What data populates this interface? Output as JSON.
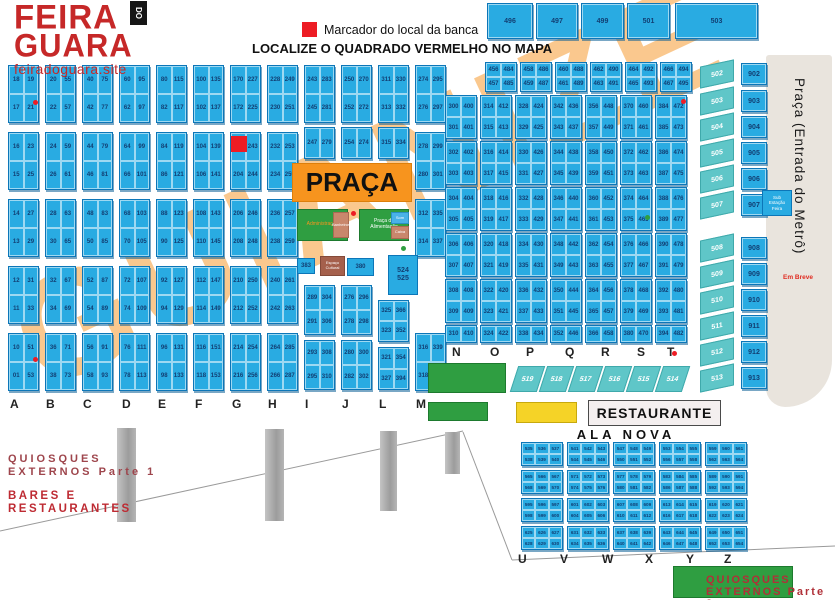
{
  "header": {
    "logo_line1": "FEIRA",
    "logo_do": "DO",
    "logo_line2": "GUARA",
    "logo_site": "feiradoguara.site",
    "legend_marker": "Marcador do local da banca",
    "headline": "LOCALIZE O QUADRADO VERMELHO NO MAPA"
  },
  "watermark": "GUIANIZE",
  "colors": {
    "cell_blue": "#29ABE2",
    "cell_border": "#0C76B8",
    "teal": "#5FC6C8",
    "orange": "#F7941E",
    "green": "#2F9E41",
    "yellow": "#F5D327",
    "red": "#ED1C24",
    "dark_red": "#BE2B33",
    "number_navy": "#123F73",
    "gray_area": "#E9E4DD",
    "brown": "#A5604C",
    "tan": "#C9876C"
  },
  "top_row": {
    "y": 3,
    "h": 36,
    "boxes": [
      [
        487,
        46,
        "496"
      ],
      [
        536,
        42,
        "497"
      ],
      [
        581,
        43,
        "499"
      ],
      [
        627,
        43,
        "501"
      ],
      [
        675,
        83,
        "503"
      ]
    ]
  },
  "mini_row": {
    "y": 62,
    "h": 30,
    "w": 32,
    "boxes": [
      [
        485,
        "456,484,457,485"
      ],
      [
        520,
        "458,486,459,487"
      ],
      [
        555,
        "460,488,461,489"
      ],
      [
        590,
        "462,490,463,491"
      ],
      [
        625,
        "464,492,465,493"
      ],
      [
        660,
        "466,494,467,495"
      ]
    ]
  },
  "left_block": {
    "w": 31,
    "letters_y": 397,
    "letters": [
      [
        "A",
        10
      ],
      [
        "B",
        46
      ],
      [
        "C",
        83
      ],
      [
        "D",
        122
      ],
      [
        "E",
        158
      ],
      [
        "F",
        195
      ],
      [
        "G",
        232
      ],
      [
        "H",
        268
      ],
      [
        "I",
        305
      ],
      [
        "J",
        342
      ],
      [
        "L",
        379
      ],
      [
        "M",
        416
      ]
    ],
    "columns": [
      {
        "x": 8,
        "boxes": [
          {
            "y": 65,
            "h": 58,
            "n": "18,19,17,21"
          },
          {
            "y": 132,
            "h": 58,
            "n": "16,23,15,25"
          },
          {
            "y": 199,
            "h": 58,
            "n": "14,27,13,29"
          },
          {
            "y": 266,
            "h": 58,
            "n": "12,31,11,33"
          },
          {
            "y": 333,
            "h": 58,
            "n": "10,51,01,53"
          }
        ]
      },
      {
        "x": 45,
        "boxes": [
          {
            "y": 65,
            "h": 58,
            "n": "20,55,22,57"
          },
          {
            "y": 132,
            "h": 58,
            "n": "24,59,26,61"
          },
          {
            "y": 199,
            "h": 58,
            "n": "28,63,30,65"
          },
          {
            "y": 266,
            "h": 58,
            "n": "32,67,34,69"
          },
          {
            "y": 333,
            "h": 58,
            "n": "36,71,38,73"
          }
        ]
      },
      {
        "x": 82,
        "boxes": [
          {
            "y": 65,
            "h": 58,
            "n": "40,75,42,77"
          },
          {
            "y": 132,
            "h": 58,
            "n": "44,79,46,81"
          },
          {
            "y": 199,
            "h": 58,
            "n": "48,83,50,85"
          },
          {
            "y": 266,
            "h": 58,
            "n": "52,87,54,89"
          },
          {
            "y": 333,
            "h": 58,
            "n": "56,91,58,93"
          }
        ]
      },
      {
        "x": 119,
        "boxes": [
          {
            "y": 65,
            "h": 58,
            "n": "60,95,62,97"
          },
          {
            "y": 132,
            "h": 58,
            "n": "64,99,66,101"
          },
          {
            "y": 199,
            "h": 58,
            "n": "68,103,70,105"
          },
          {
            "y": 266,
            "h": 58,
            "n": "72,107,74,109"
          },
          {
            "y": 333,
            "h": 58,
            "n": "76,111,78,113"
          }
        ]
      },
      {
        "x": 156,
        "boxes": [
          {
            "y": 65,
            "h": 58,
            "n": "80,115,82,117"
          },
          {
            "y": 132,
            "h": 58,
            "n": "84,119,86,121"
          },
          {
            "y": 199,
            "h": 58,
            "n": "88,123,90,125"
          },
          {
            "y": 266,
            "h": 58,
            "n": "92,127,94,129"
          },
          {
            "y": 333,
            "h": 58,
            "n": "96,131,98,133"
          }
        ]
      },
      {
        "x": 193,
        "boxes": [
          {
            "y": 65,
            "h": 58,
            "n": "100,135,102,137"
          },
          {
            "y": 132,
            "h": 58,
            "n": "104,139,106,141"
          },
          {
            "y": 199,
            "h": 58,
            "n": "108,143,110,145"
          },
          {
            "y": 266,
            "h": 58,
            "n": "112,147,114,149"
          },
          {
            "y": 333,
            "h": 58,
            "n": "116,151,118,153"
          }
        ]
      },
      {
        "x": 230,
        "boxes": [
          {
            "y": 65,
            "h": 58,
            "n": "170,227,172,225"
          },
          {
            "y": 132,
            "h": 58,
            "n": ",243,204,244"
          },
          {
            "y": 199,
            "h": 58,
            "n": "206,246,208,248"
          },
          {
            "y": 266,
            "h": 58,
            "n": "210,250,212,252"
          },
          {
            "y": 333,
            "h": 58,
            "n": "214,254,216,256"
          }
        ]
      },
      {
        "x": 267,
        "boxes": [
          {
            "y": 65,
            "h": 58,
            "n": "228,249,230,251"
          },
          {
            "y": 132,
            "h": 58,
            "n": "232,253,234,255"
          },
          {
            "y": 199,
            "h": 58,
            "n": "236,257,238,259"
          },
          {
            "y": 266,
            "h": 58,
            "n": "240,261,242,263"
          },
          {
            "y": 333,
            "h": 58,
            "n": "264,285,266,287"
          }
        ]
      },
      {
        "x": 304,
        "boxes": [
          {
            "y": 65,
            "h": 58,
            "n": "243,283,245,281"
          },
          {
            "y": 127,
            "h": 32,
            "n": "247,279"
          },
          {
            "y": 285,
            "h": 50,
            "n": "289,304,291,306"
          },
          {
            "y": 340,
            "h": 50,
            "n": "293,308,295,310"
          }
        ]
      },
      {
        "x": 341,
        "boxes": [
          {
            "y": 65,
            "h": 58,
            "n": "250,270,252,272"
          },
          {
            "y": 127,
            "h": 32,
            "n": "254,274"
          },
          {
            "y": 285,
            "h": 50,
            "n": "276,296,278,298"
          },
          {
            "y": 340,
            "h": 50,
            "n": "280,300,282,302"
          }
        ]
      },
      {
        "x": 378,
        "boxes": [
          {
            "y": 65,
            "h": 58,
            "n": "311,330,313,332"
          },
          {
            "y": 127,
            "h": 32,
            "n": "315,334"
          },
          {
            "y": 300,
            "h": 42,
            "n": "325,366,323,352"
          },
          {
            "y": 347,
            "h": 43,
            "n": "321,354,327,394"
          }
        ]
      },
      {
        "x": 415,
        "boxes": [
          {
            "y": 65,
            "h": 58,
            "n": "274,295,276,297"
          },
          {
            "y": 132,
            "h": 58,
            "n": "278,299,280,301"
          },
          {
            "y": 199,
            "h": 58,
            "n": "312,335,314,337"
          },
          {
            "y": 333,
            "h": 58,
            "n": "316,339,318,341"
          }
        ]
      }
    ]
  },
  "right_block": {
    "w": 32,
    "letters_y": 345,
    "letters": [
      [
        "N",
        452
      ],
      [
        "O",
        490
      ],
      [
        "P",
        526
      ],
      [
        "Q",
        565
      ],
      [
        "R",
        601
      ],
      [
        "S",
        637
      ],
      [
        "T",
        667
      ]
    ],
    "x": [
      445,
      480,
      515,
      550,
      585,
      620,
      655
    ],
    "rows": [
      {
        "y": 95,
        "h": 44
      },
      {
        "y": 141,
        "h": 44
      },
      {
        "y": 187,
        "h": 44
      },
      {
        "y": 233,
        "h": 44
      },
      {
        "y": 279,
        "h": 44
      },
      {
        "y": 325,
        "h": 18
      }
    ],
    "nums": [
      [
        "300,400,301,401",
        "302,402,303,403",
        "304,404,305,405",
        "306,406,307,407",
        "308,408,309,409",
        "310,410"
      ],
      [
        "314,412,315,413",
        "316,414,317,415",
        "318,416,319,417",
        "320,418,321,419",
        "322,420,323,421",
        "324,422"
      ],
      [
        "328,424,329,425",
        "330,426,331,427",
        "332,428,333,429",
        "334,430,335,431",
        "336,432,337,433",
        "338,434"
      ],
      [
        "342,436,343,437",
        "344,438,345,439",
        "346,440,347,441",
        "348,442,349,443",
        "350,444,351,445",
        "352,446"
      ],
      [
        "356,448,357,449",
        "358,450,359,451",
        "360,452,361,453",
        "362,454,363,455",
        "364,456,365,457",
        "366,458"
      ],
      [
        "370,460,371,461",
        "372,462,373,463",
        "374,464,375,465",
        "376,466,377,467",
        "378,468,379,469",
        "380,470"
      ],
      [
        "384,472,385,473",
        "386,474,387,475",
        "388,476,389,477",
        "390,478,391,479",
        "392,480,393,481",
        "394,482"
      ]
    ]
  },
  "teal_row": {
    "y": 366,
    "w": 27,
    "h": 26,
    "cells": [
      [
        514,
        "519"
      ],
      [
        543,
        "518"
      ],
      [
        572,
        "517"
      ],
      [
        601,
        "516"
      ],
      [
        630,
        "515"
      ],
      [
        659,
        "514"
      ]
    ]
  },
  "teal_col": {
    "x": 700,
    "w": 34,
    "h": 22,
    "cells": [
      [
        63,
        "502"
      ],
      [
        90,
        "503"
      ],
      [
        116,
        "504"
      ],
      [
        142,
        "505"
      ],
      [
        168,
        "506"
      ],
      [
        194,
        "507"
      ],
      [
        237,
        "508"
      ],
      [
        263,
        "509"
      ],
      [
        289,
        "510"
      ],
      [
        315,
        "511"
      ],
      [
        341,
        "512"
      ],
      [
        367,
        "513"
      ]
    ]
  },
  "blue_col": {
    "x": 741,
    "w": 26,
    "h": 22,
    "cells": [
      [
        63,
        "902"
      ],
      [
        90,
        "903"
      ],
      [
        116,
        "904"
      ],
      [
        142,
        "905"
      ],
      [
        168,
        "906"
      ],
      [
        194,
        "907"
      ],
      [
        237,
        "908"
      ],
      [
        263,
        "909"
      ],
      [
        289,
        "910"
      ],
      [
        315,
        "911"
      ],
      [
        341,
        "912"
      ],
      [
        367,
        "913"
      ]
    ]
  },
  "ala_nova_grid": {
    "x": [
      521,
      567,
      613,
      659,
      705
    ],
    "y": [
      442,
      470,
      498,
      526
    ],
    "w": 42,
    "h": 24,
    "letters_y": 552,
    "letters": [
      [
        "U",
        518
      ],
      [
        "V",
        560
      ],
      [
        "W",
        602
      ],
      [
        "X",
        645
      ],
      [
        "Y",
        686
      ],
      [
        "Z",
        724
      ]
    ],
    "nums": [
      "535,536,537,538,539,540",
      "541,542,543,544,545,546",
      "547,548,549,550,551,552",
      "553,554,555,556,557,558",
      "559,560,561,562,563,564",
      "565,566,567,568,569,570",
      "571,572,573,574,575,576",
      "577,578,579,580,581,582",
      "583,584,585,586,587,588",
      "589,590,591,592,593,594",
      "595,596,597,598,599,600",
      "601,602,603,604,605,606",
      "607,608,609,610,611,612",
      "613,614,615,616,617,618",
      "619,620,621,622,623,624",
      "625,626,627,628,629,630",
      "631,632,633,634,635,636",
      "637,638,639,640,641,642",
      "643,644,645,646,647,648",
      "649,650,651,652,653,654"
    ]
  },
  "facilities": [
    {
      "name": "praca-box",
      "x": 292,
      "y": 163,
      "w": 120,
      "h": 39,
      "bg": "#F7941E",
      "border": "#DD7F0B",
      "fg": "#111111",
      "fs": 26,
      "bold": true,
      "text": "PRAÇA"
    },
    {
      "name": "administracao-box",
      "x": 297,
      "y": 209,
      "w": 51,
      "h": 32,
      "bg": "#2F9E41",
      "border": "#1d7a2e",
      "fg": "#F7941E",
      "fs": 5,
      "text": "Administração"
    },
    {
      "name": "banheiros-box",
      "x": 333,
      "y": 212,
      "w": 16,
      "h": 26,
      "bg": "#C9876C",
      "border": "#a96a52",
      "fg": "#ffffff",
      "fs": 4,
      "text": "Banheiros"
    },
    {
      "name": "alimentacao-box",
      "x": 359,
      "y": 209,
      "w": 50,
      "h": 32,
      "bg": "#2F9E41",
      "border": "#1d7a2e",
      "fg": "#ffffff",
      "fs": 5,
      "text": "Praça de\nAlimentação"
    },
    {
      "name": "som-box",
      "x": 391,
      "y": 212,
      "w": 18,
      "h": 12,
      "bg": "#49B2E8",
      "border": "#2a8fc4",
      "fg": "#ffffff",
      "fs": 4,
      "text": "Som"
    },
    {
      "name": "caixa-box",
      "x": 391,
      "y": 226,
      "w": 18,
      "h": 13,
      "bg": "#C9876C",
      "border": "#a96a52",
      "fg": "#ffffff",
      "fs": 4,
      "text": "Caixa"
    },
    {
      "name": "stall-383",
      "x": 297,
      "y": 258,
      "w": 18,
      "h": 16,
      "bg": "#29ABE2",
      "border": "#0C76B8",
      "fg": "#123F73",
      "fs": 6,
      "bold": true,
      "text": "383"
    },
    {
      "name": "espaco-cultural-box",
      "x": 320,
      "y": 256,
      "w": 25,
      "h": 20,
      "bg": "#A5604C",
      "border": "#844a39",
      "fg": "#ffffff",
      "fs": 4,
      "text": "Espaço\nCultural"
    },
    {
      "name": "stall-380",
      "x": 347,
      "y": 258,
      "w": 27,
      "h": 18,
      "bg": "#29ABE2",
      "border": "#0C76B8",
      "fg": "#123F73",
      "fs": 6,
      "bold": true,
      "text": "380"
    },
    {
      "name": "stall-524-525",
      "x": 388,
      "y": 255,
      "w": 30,
      "h": 40,
      "bg": "#29ABE2",
      "border": "#0C76B8",
      "fg": "#123F73",
      "fs": 7,
      "bold": true,
      "text": "524\n525"
    },
    {
      "name": "sub-estacao-box",
      "x": 762,
      "y": 190,
      "w": 30,
      "h": 26,
      "bg": "#29ABE2",
      "border": "#0C76B8",
      "fg": "#ffffff",
      "fs": 4.5,
      "text": "Sub\nEstação\nFeira"
    },
    {
      "name": "green-area-1",
      "x": 428,
      "y": 363,
      "w": 78,
      "h": 30,
      "bg": "#2F9E41",
      "border": "#1d7a2e",
      "fg": "#ffffff",
      "fs": 5,
      "text": ""
    },
    {
      "name": "green-area-2",
      "x": 428,
      "y": 402,
      "w": 60,
      "h": 19,
      "bg": "#2F9E41",
      "border": "#1d7a2e",
      "fg": "#ffffff",
      "fs": 5,
      "text": ""
    },
    {
      "name": "yellow-area",
      "x": 516,
      "y": 402,
      "w": 61,
      "h": 21,
      "bg": "#F5D327",
      "border": "#C7A90E",
      "fg": "#111111",
      "fs": 5,
      "text": ""
    },
    {
      "name": "green-area-3",
      "x": 673,
      "y": 566,
      "w": 120,
      "h": 32,
      "bg": "#2F9E41",
      "border": "#1d7a2e",
      "fg": "#ffffff",
      "fs": 5,
      "text": ""
    }
  ],
  "red_marker": {
    "x": 231,
    "y": 136,
    "w": 16,
    "h": 16
  },
  "dots": {
    "red": [
      [
        33,
        100
      ],
      [
        33,
        357
      ],
      [
        351,
        211
      ],
      [
        672,
        351
      ],
      [
        681,
        99
      ]
    ],
    "green": [
      [
        401,
        246
      ],
      [
        645,
        215
      ]
    ]
  },
  "pillars": [
    [
      117,
      428,
      19,
      94
    ],
    [
      265,
      429,
      19,
      92
    ],
    [
      380,
      431,
      17,
      80
    ],
    [
      445,
      432,
      15,
      42
    ]
  ],
  "lines": [
    "0,531 463,431",
    "463,432 512,560",
    "512,560 835,546"
  ],
  "metro": {
    "label": "Praça (Entrada do Metrô)",
    "em_breve": "Em Breve"
  },
  "bottom": {
    "restaurante": "RESTAURANTE",
    "ala_nova": "ALA NOVA",
    "quiosques1_line1": "QUIOSQUES",
    "quiosques1_line2": "EXTERNOS Parte 1",
    "bares_line1": "BARES E",
    "bares_line2": "RESTAURANTES",
    "quiosques2_line1": "QUIOSQUES",
    "quiosques2_line2": "EXTERNOS Parte 2"
  }
}
